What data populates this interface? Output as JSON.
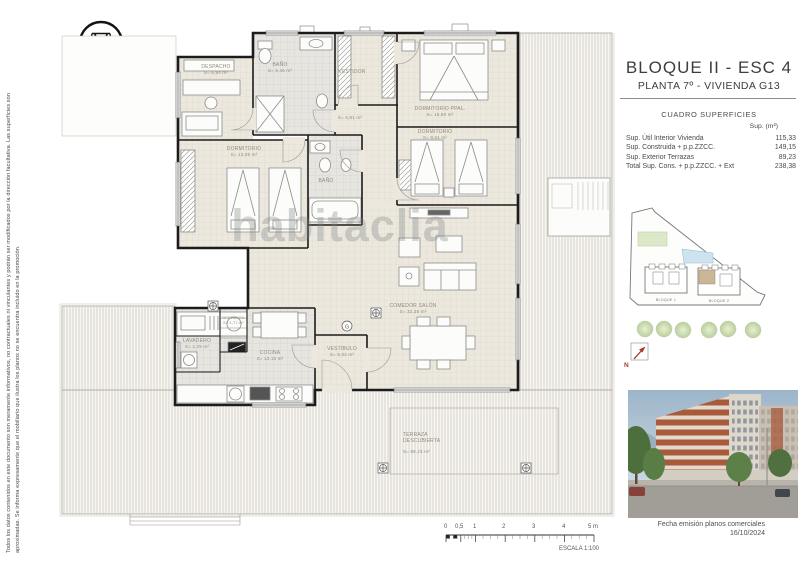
{
  "disclaimer": {
    "line1": "Todos los datos contenidos en este documento son meramente informativos, no contractuales ni vinculantes y podrán ser modificados por la dirección facultativa. Las superficies son",
    "line2": "aproximadas. Se informa expresamente que el mobiliario que ilustra los planos no se encuentra incluido en la promoción."
  },
  "logo": {
    "name": "GANDÍA HILLS",
    "tagline": "RESIDENCIAL EXCLUSIVO"
  },
  "header": {
    "title": "BLOQUE II - ESC 4",
    "subtitle": "PLANTA 7º - VIVIENDA G13"
  },
  "surfaces": {
    "title": "CUADRO SUPERFICIES",
    "unit_header": "Sup. (m²)",
    "rows": [
      {
        "label": "Sup. Útil Interior Vivienda",
        "value": "115,33"
      },
      {
        "label": "Sup. Construida + p.p.ZZCC.",
        "value": "149,15"
      },
      {
        "label": "Sup. Exterior Terrazas",
        "value": "89,23"
      },
      {
        "label": "Total Sup. Cons. + p.p.ZZCC. + Ext",
        "value": "238,38"
      }
    ]
  },
  "floorplan": {
    "watermark": "habitaclia",
    "entry_marker": "G",
    "rooms": {
      "despacho": {
        "name": "DESPACHO",
        "area": "S= 6,94 m²"
      },
      "bano1": {
        "name": "BAÑO",
        "area": "S= 5,46 m²"
      },
      "vestidor": {
        "name": "VESTIDOR",
        "area": ""
      },
      "dorm_ppal": {
        "name": "DORMITORIO PPAL.",
        "area": "S= 15,80 m²"
      },
      "dorm2": {
        "name": "DORMITORIO",
        "area": "S= 9,61 m²"
      },
      "dorm3": {
        "name": "DORMITORIO",
        "area": "S= 13,05 m²"
      },
      "bano2": {
        "name": "BAÑO",
        "area": ""
      },
      "distribuidor": {
        "name": "",
        "area": "S= 6,81 m²"
      },
      "comedor": {
        "name": "COMEDOR SALÓN",
        "area": "S= 32,38 m²"
      },
      "vestibulo": {
        "name": "VESTÍBULO",
        "area": "S= 5,02 m²"
      },
      "cocina": {
        "name": "COCINA",
        "area": "S= 13,10 m²"
      },
      "lavadero": {
        "name": "LAVADERO",
        "area": "S= 2,25 m²"
      },
      "despensa": {
        "name": "DESPENSA",
        "area": "S= 1,77 m²"
      },
      "terraza": {
        "name": "TERRAZA DESCUBIERTA",
        "area": "S= 89,23 m²"
      }
    }
  },
  "site_plan": {
    "block1": "BLOQUE 1",
    "block2": "BLOQUE 2"
  },
  "north_label": "N",
  "scalebar": {
    "ticks": [
      "0",
      "0,5",
      "1",
      "2",
      "3",
      "4",
      "5 m"
    ],
    "caption": "ESCALA 1:100"
  },
  "issue": {
    "caption": "Fecha emisión planos comerciales",
    "date": "16/10/2024"
  },
  "colors": {
    "wall": "#1c1c1c",
    "north_red": "#a93a2e",
    "highlight_unit": "#cbb696"
  }
}
